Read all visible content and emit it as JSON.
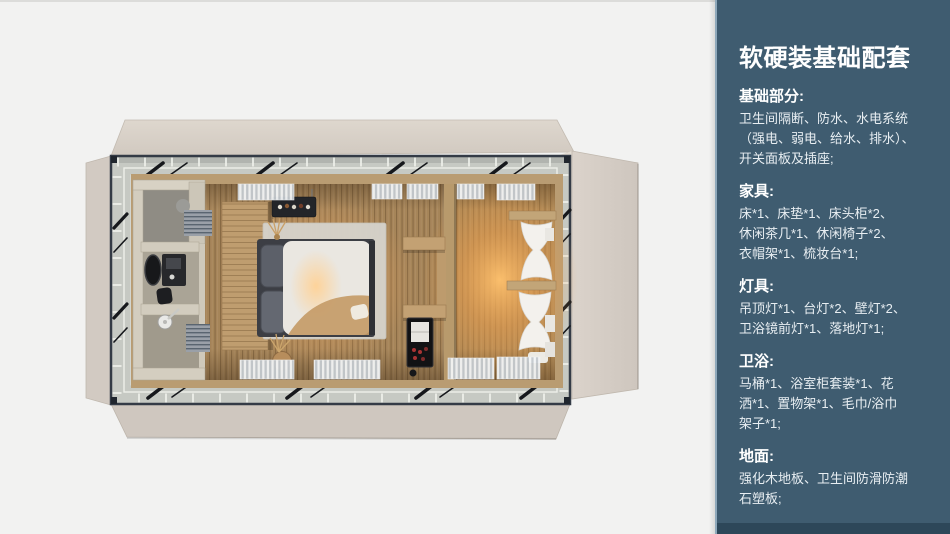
{
  "floorplan": {
    "alt": "top-down 3D render of a prefab cabin guest room with bathroom, bed and wardrobe area",
    "colors": {
      "shell_panels": "#d6cec6",
      "steel_frame": "#343b46",
      "walkway": "#c6c9c3",
      "wood_floor": "#a2845c",
      "warm_glow": "#f0b468"
    }
  },
  "sidebar": {
    "background": "#3f5c70",
    "edge_highlight": "#8fa9bb",
    "bottom_strip": "#2d4759",
    "text_color": "#ffffff",
    "title": "软硬装基础配套",
    "sections": [
      {
        "heading": "基础部分:",
        "lines": [
          "卫生间隔断、防水、水电系统",
          "（强电、弱电、给水、排水）、",
          "开关面板及插座;"
        ]
      },
      {
        "heading": "家具:",
        "lines": [
          "床*1、床垫*1、床头柜*2、",
          "休闲茶几*1、休闲椅子*2、",
          "衣帽架*1、梳妆台*1;"
        ]
      },
      {
        "heading": "灯具:",
        "lines": [
          "吊顶灯*1、台灯*2、壁灯*2、",
          "卫浴镜前灯*1、落地灯*1;"
        ]
      },
      {
        "heading": "卫浴:",
        "lines": [
          "马桶*1、浴室柜套装*1、花",
          "洒*1、置物架*1、毛巾/浴巾",
          "架子*1;"
        ]
      },
      {
        "heading": "地面:",
        "lines": [
          "强化木地板、卫生间防滑防潮",
          "石塑板;"
        ]
      }
    ]
  }
}
